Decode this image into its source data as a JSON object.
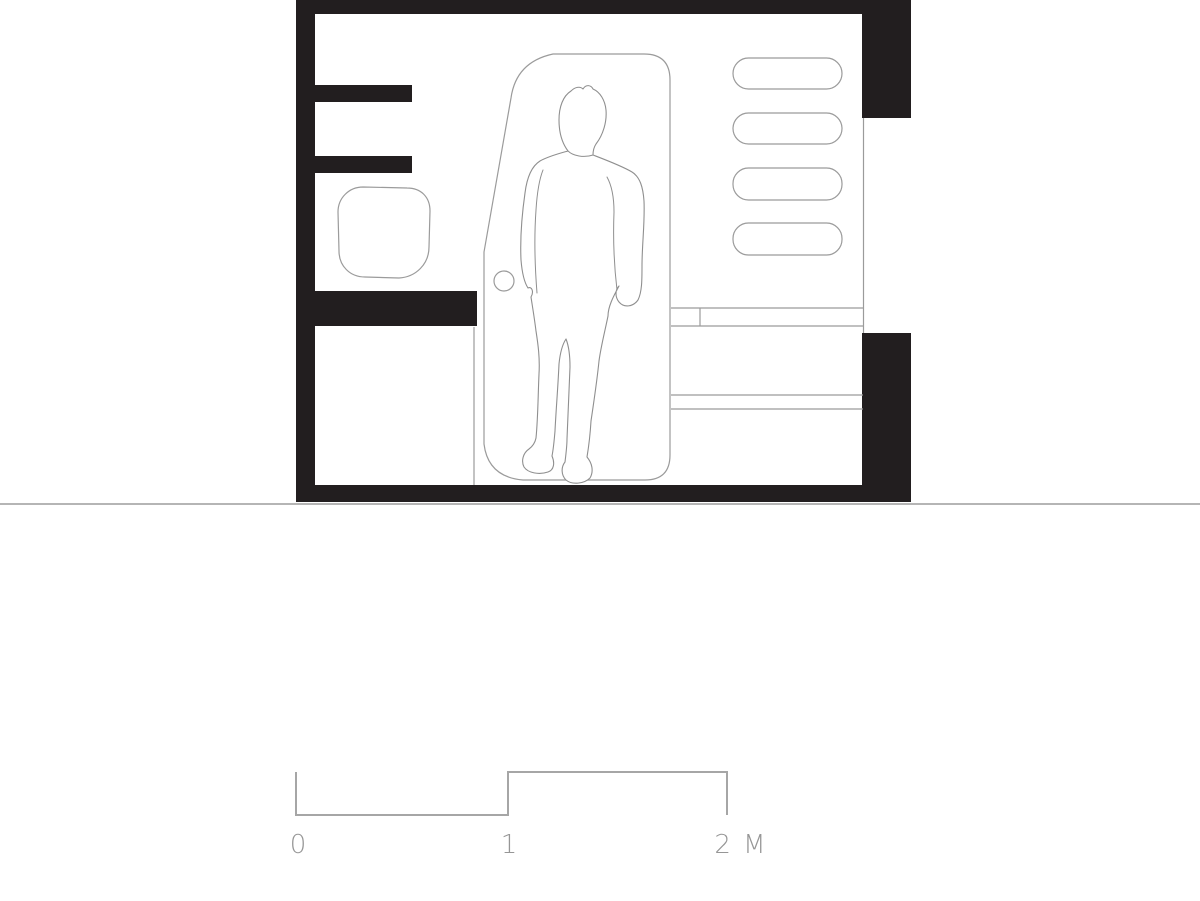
{
  "drawing": {
    "type": "architectural-section",
    "description": "Black-and-white sectional elevation of a compact room (bathroom/cabin) with a standing human figure for scale, wall niches, shelves, a washbasin, counters with drawers, and a door panel",
    "room": {
      "walls": [
        "top",
        "left",
        "right-with-window",
        "floor-slab"
      ],
      "left_wall_shelves": 2,
      "right_wall_niches": 4,
      "fixtures": [
        "washbasin",
        "counter-slab",
        "base-cabinet",
        "drawer-unit",
        "door-panel",
        "door-knob"
      ],
      "figure": "standing-person-silhouette"
    }
  },
  "scale_bar": {
    "labels": {
      "start": "0",
      "middle": "1",
      "end": "2 M"
    },
    "unit": "M",
    "ticks": [
      0,
      1,
      2
    ]
  },
  "colors": {
    "background": "#ffffff",
    "wall_fill": "#221e1f",
    "thin_line": "#9b9b9b",
    "figure_line": "#8f8f8f",
    "ground_line": "#b5b5b5",
    "scale_line": "#a6a6a6",
    "scale_text": "#969696"
  }
}
